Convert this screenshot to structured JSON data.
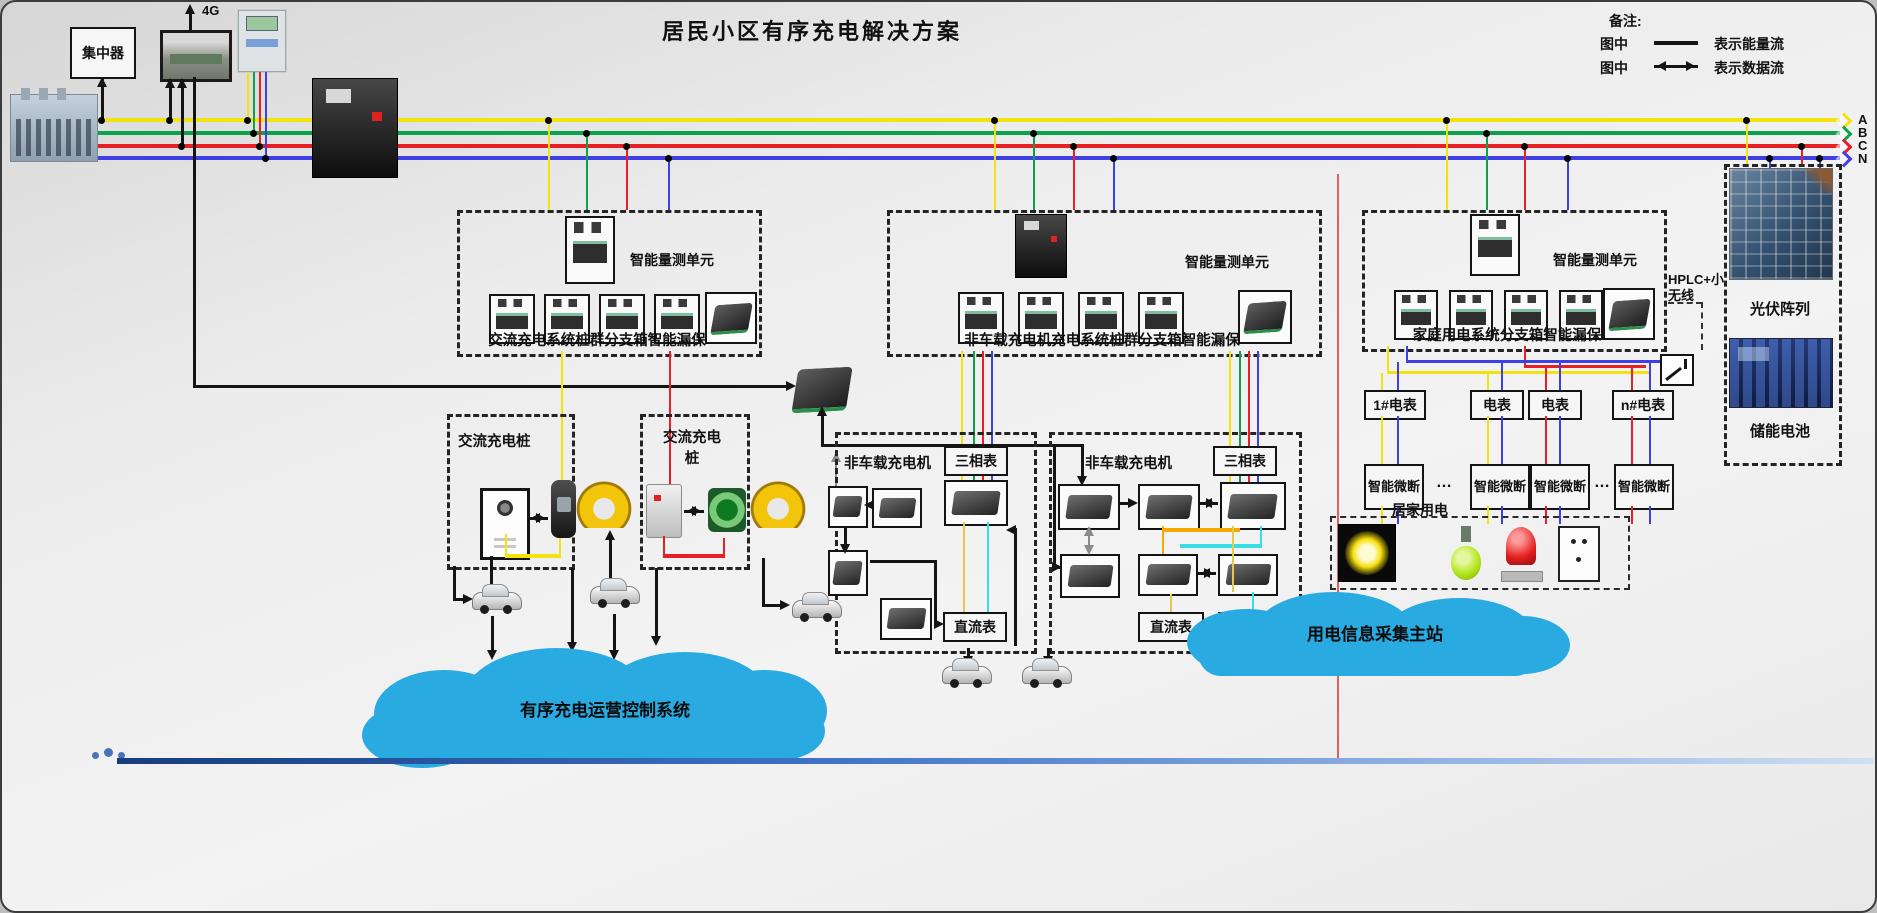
{
  "title": "居民小区有序充电解决方案",
  "legend": {
    "heading": "备注:",
    "energy_prefix": "图中",
    "energy_label": "表示能量流",
    "data_prefix": "图中",
    "data_label": "表示数据流"
  },
  "supply": {
    "concentrator": "集中器",
    "uplink": "4G",
    "phases": [
      {
        "name": "A",
        "color": "#f2e20e"
      },
      {
        "name": "B",
        "color": "#0ca24c"
      },
      {
        "name": "C",
        "color": "#ea1f26"
      },
      {
        "name": "N",
        "color": "#3f3fe8"
      }
    ]
  },
  "measure_units": {
    "unit_label": "智能量测单元",
    "caption_ac": "交流充电系统桩群分支箱智能漏保",
    "caption_dc": "非车载充电机充电系统桩群分支箱智能漏保",
    "caption_home": "家庭用电系统分支箱智能漏保"
  },
  "charging": {
    "ac_pile_1": "交流充电桩",
    "ac_pile_2": "交流充电桩",
    "dc_label_1": "非车载充电机",
    "dc_label_2": "非车载充电机",
    "phase_meter": "三相表",
    "dc_meter": "直流表"
  },
  "household": {
    "meter_1": "1#电表",
    "meter_2": "电表",
    "meter_3": "电表",
    "meter_n": "n#电表",
    "ellipsis": "…",
    "smart_breaker": "智能微断",
    "home_label": "居家用电",
    "hplc": "HPLC+小无线"
  },
  "side_panel": {
    "pv": "光伏阵列",
    "battery": "储能电池"
  },
  "clouds": {
    "control": "有序充电运营控制系统",
    "master": "用电信息采集主站",
    "color": "#29abe2"
  }
}
